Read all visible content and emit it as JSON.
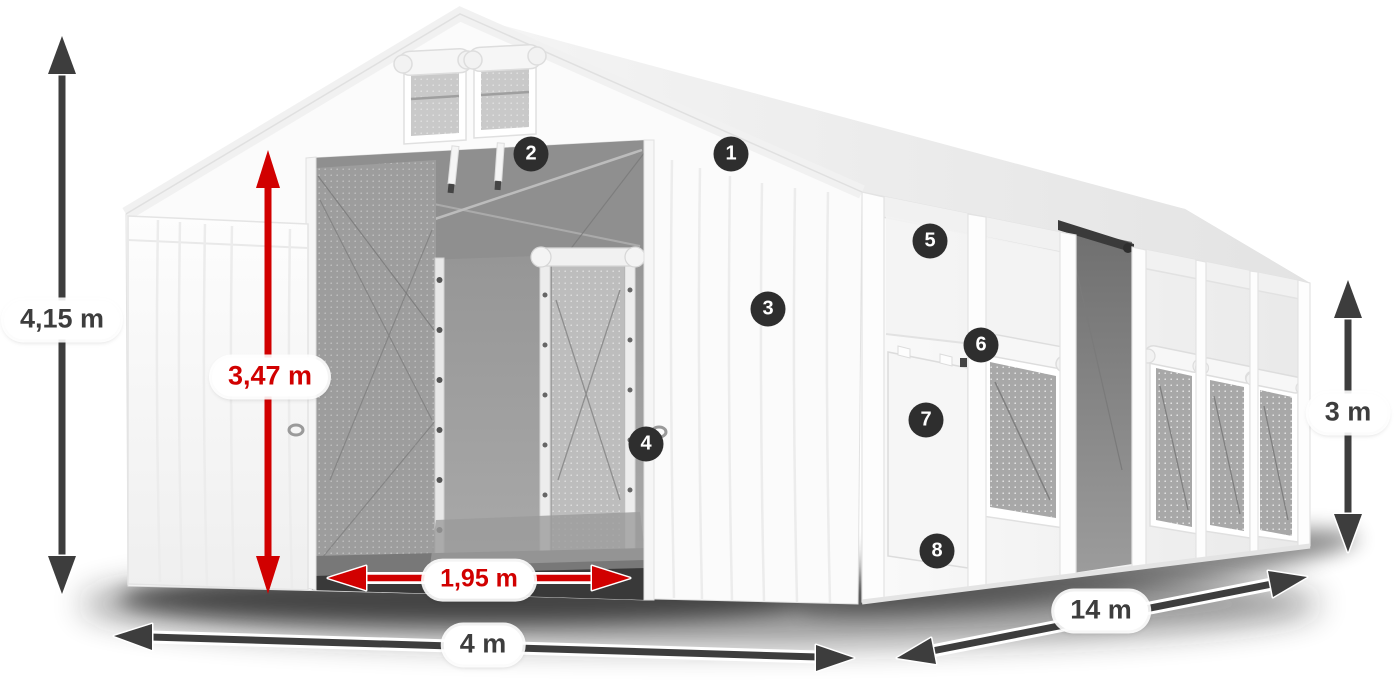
{
  "diagram": {
    "dimensions": [
      {
        "id": "total-height",
        "label": "4,15 m",
        "style": "dark",
        "orientation": "vertical"
      },
      {
        "id": "entrance-height",
        "label": "3,47 m",
        "style": "red",
        "orientation": "vertical"
      },
      {
        "id": "entrance-width",
        "label": "1,95 m",
        "style": "red",
        "orientation": "horizontal"
      },
      {
        "id": "front-width",
        "label": "4 m",
        "style": "dark",
        "orientation": "horizontal"
      },
      {
        "id": "length",
        "label": "14 m",
        "style": "dark",
        "orientation": "diagonal"
      },
      {
        "id": "side-height",
        "label": "3 m",
        "style": "dark",
        "orientation": "vertical"
      }
    ],
    "hotspots": [
      {
        "label": "1"
      },
      {
        "label": "2"
      },
      {
        "label": "3"
      },
      {
        "label": "4"
      },
      {
        "label": "5"
      },
      {
        "label": "6"
      },
      {
        "label": "7"
      },
      {
        "label": "8"
      }
    ],
    "colors": {
      "dimension_dark": "#3d3d3d",
      "dimension_red": "#d10000",
      "hotspot_background": "#2e2e2e",
      "hotspot_text": "#ffffff",
      "tent_fabric": "#fbfbfb",
      "mesh_interior": "#9d9d9d"
    }
  }
}
